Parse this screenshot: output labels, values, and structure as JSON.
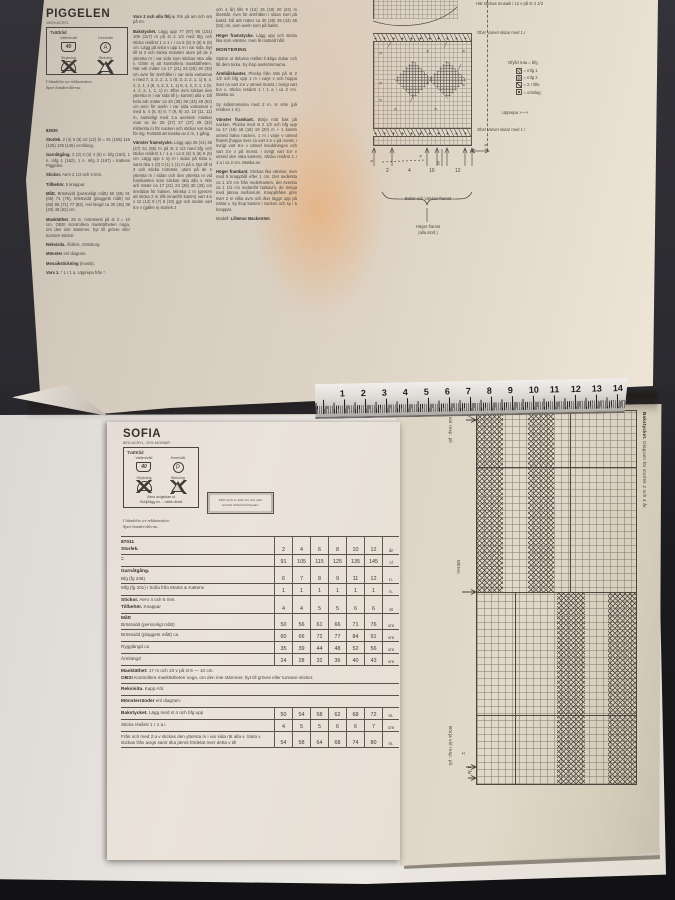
{
  "scene": {
    "background": "#2b2a2f",
    "paper_tan": "#d9cfc2",
    "paper_white": "#e7e3de",
    "glare": "#ee9646",
    "ink": "#474340"
  },
  "piggelen": {
    "title": "PIGGELEN",
    "subtitle": "100% ACRYL",
    "care": {
      "header": "Tvättråd",
      "wash": "Vattentvätt",
      "wash_temp": "40",
      "dry": "Kemtvätt",
      "dry_letter": "A",
      "iron": "Strykning",
      "bleach": "Blekning"
    },
    "reklamation": "I händelse av reklamation:",
    "reklamation2": "Spar banderollerna.",
    "columns": [
      [
        {
          "b": "83030",
          "t": ""
        },
        {
          "b": "Storlek.",
          "t": " 2 (4) 6 (8) 10 (12) år = 91 (105) 115 (125) 135 (145) centilong."
        },
        {
          "b": "Garnåtgång.",
          "t": " 2 (3) 3 (4) 4 (5) n. bfg (150), 1 n. mfg 1 (162), 1 n. mfg 2 (167) i Kattens Piggelen."
        },
        {
          "b": "Stickor.",
          "t": " Aero 2 1/2 och 3 mm."
        },
        {
          "b": "Tillbehör.",
          "t": " 5 knappar."
        },
        {
          "b": "Mått.",
          "t": " Bröstvidd (personligt mått) 50 (56) 61 (66) 71 (76), bröstvidd (plaggets mått) 54 (60) 66 (71) 77 (82). Hel längd ca 30 (35) 39 (43) 48 (52) cm."
        },
        {
          "b": "Masktäthet.",
          "t": " 28 m. mönsterst på st 3 = 10 cm. OBS! Kontrollera masktätheten noga, om den inte stämmer, byt till grövre eller tunnare stickor."
        },
        {
          "b": "Rekvisita.",
          "t": " Åhléns, Göteborg."
        },
        {
          "b": "Mönster",
          "t": " enl diagram."
        },
        {
          "b": "Mosaikstickning",
          "t": " (mosst)."
        },
        {
          "b": "Varv 1.",
          "t": " * 1 r 1 a. Upprepa från *."
        }
      ],
      [
        {
          "b": "Varv 2 och alla följ v.",
          "t": " Rm på am och am på rm."
        },
        {
          "b": "Bakstycket.",
          "t": " Lägg upp 77 (87) 95 (101) 109 (117) m på st 2 1/2 med bfg och sticka resårst 1 a 1 r i ca 5 (5) 5 (6) 6 (6) cm. Lägg på sista v upp 1 m i var sida. Byt till st 3 och sticka mönster utom på de 2 yttersta m i var sida som stickas räta alla v. Glöm ej att kontrollera masktätheten. När arb mäter ca 17 (21) 23 (26) 30 (33) cm avm för ärmhålen i var sida vartannat v med 7, 3, 2, 2, 1, 1 (8, 3, 2, 2, 1, 1) 8, 4, 2, 2, 1, 1 (8, 4, 2, 2, 1, 1) 8, 4, 2, 2, 1, 1 (8, 4, 2, 2, 1, 1, 1) m. Efter avm stickas den yttersta m i var sida till (= kantm) alla v. Då hela arb mäter ca 30 (35) 39 (43) 48 (52) cm avm för axeln i var sida vartannat v med 5, 4 (6, 6) 8, 7 (9, 9) 10, 10 (11, 11) m, samtidigt med 1:a axelavm maskar man av de 25 (27) 27 (27) 29 (33) mittersta m för nacken och stickar var sida för sig. Fortsätt att maska av 2 m, 1 gång."
        },
        {
          "b": "Vänster framstycke.",
          "t": " Lägg upp 35 (41) 45 (47) 51 (55) m på st 2 1/2 med bfg och sticka resårst 1 r 1 a i ca 5 (5) 5 (6) 6 (6) cm. Lägg upp 1 ny m i sidan på sista v, samt öka 1 (0) 0 (1) 1 (1) m på v. Byt till st 3 och sticka mönster, utom på de 2 yttersta m i sidan och den yttersta m vid framkanten som stickas räta alla v. När arb mäter ca 17 (21) 23 (26) 30 (33) cm sneddas för halsen. Minska 1 m (genom att sticka 2 m tills innanför kantm) vart 4:e v 12 (13) 9 (7) 8 (10) ggr och sedan vart 6:e v (gäller ej storlek 2"
        }
      ],
      [
        {
          "b": "",
          "t": "och 4 år) tills 9 (12) 15 (18) 20 (22) m återstår. Avm för ärmhålen i sidan som på bakst. Då arb mäter ca 30 (35) 39 (43) 48 (52) cm, avm axeln som på bakst."
        },
        {
          "b": "Höger framstycke.",
          "t": " Lägg upp och sticka lika som vänster, men åt motsatt håll."
        },
        {
          "h": "MONTERING"
        },
        {
          "b": "",
          "t": "Spänn ut delarna mellan fuktiga dukar och låt dem torka. Sy ihop axelsömmarna."
        },
        {
          "b": "Ärmhålskanter.",
          "t": " Plocka från räts på st 2 1/2 och bfg upp 1 m i varje v och hoppa över ca vart 3:e v utmed mosst, i övrigt vart 5:e v. Sticka resårst 1 r 1 a i ca 2 cm. Maska av."
        },
        {
          "b": "",
          "t": "Sy sidsömmarna med 2 m. st söm (på resåren 1 m)."
        },
        {
          "b": "Vänster framkant.",
          "t": " Börja mitt bak på nacken. Plocka med st 2 1/2 och bfg upp ca 17 (18) 18 (18) 19 (20) m + 1 kantm utmed halva nacken, 1 m i varje v utmed framst (hoppa över ca vart 4:e v på mosst, i övrigt vart 6:e v utmed sneddningen och vart 3:e v på mosst, i övrigt vart 5:e v utmed den raka kanten). Sticka resårst 1 r 1 a i ca 2 cm. Maska av."
        },
        {
          "b": "Höger framkant.",
          "t": " Stickas lika vänster, men med 5 knapphål efter 1 cm. Det nedersta ca 1 1/2 cm från nederkanten, det översta ca 1 1/2 cm nedanför halsavm, de övriga med jämna mellanrum. Knapphålen görs över 2 m vilka avm och åter läggs upp på nästa v. Sy ihop kanten i nacken och sy i 5 knappar."
        },
        {
          "b": "Lillemor Bäckström",
          "t": "",
          "pre": "Modell: "
        }
      ]
    ],
    "chart": {
      "top_note": "Här stickas mosaik i 12 v på st 2 1/2",
      "end_note": "Obs! Varvet slutar med 1 r",
      "legend_title": "Ofylld ruta = bfg",
      "legend": [
        {
          "key": "mfg1",
          "label": "= mfg 1"
        },
        {
          "key": "mfg2",
          "label": "= mfg 2"
        },
        {
          "key": "rtills",
          "label": "= 2 r tills."
        },
        {
          "key": "omslag",
          "label": "= omslag"
        }
      ],
      "repeat_note": "Upprepa ×—×",
      "size_marks": [
        "2",
        "4",
        "10",
        "6",
        "12"
      ],
      "bracket_label": "Bakst och vänster framst",
      "below_label_1": "Höger framst",
      "below_label_2": "(alla storl.)"
    }
  },
  "ruler": {
    "numbers": [
      "1",
      "2",
      "3",
      "4",
      "5",
      "6",
      "7",
      "8",
      "9",
      "10",
      "11",
      "12",
      "13",
      "14"
    ]
  },
  "sofia": {
    "title": "SOFIA",
    "subtitle": "80% ACRYL, 20% MOHAIR",
    "care": {
      "header": "Tvättråd",
      "wash": "Vattentvätt",
      "wash_temp": "40",
      "dry": "Kemtvätt",
      "dry_letter": "P",
      "iron": "Strykning",
      "bleach": "Blekning",
      "note1": "Vänd avigsidan ut",
      "note2": "Skölj/lägg ev. – häfta direkt"
    },
    "copyright_1": "Eftertryck av bild och text utan",
    "copyright_2": "särskilt tillstånd förbjudes.",
    "reklamation": "I händelse av reklamation:",
    "reklamation2": "Spar banderollerna.",
    "table": {
      "rows": [
        {
          "lines": [
            {
              "b": "87011",
              "t": ""
            },
            {
              "b": "Storlek.",
              "t": ""
            }
          ],
          "vals": [
            "2",
            "4",
            "6",
            "8",
            "10",
            "12"
          ],
          "unit": "år"
        },
        {
          "lines": [
            {
              "b": "=",
              "t": ""
            }
          ],
          "vals": [
            "91",
            "105",
            "115",
            "125",
            "135",
            "145"
          ],
          "unit": "cl"
        },
        {
          "lines": [
            {
              "b": "Garnåtgång.",
              "t": ""
            },
            {
              "b": "",
              "t": "Bfg (fg 238)"
            }
          ],
          "vals": [
            "6",
            "7",
            "8",
            "9",
            "11",
            "12"
          ],
          "unit": "n."
        },
        {
          "lines": [
            {
              "b": "",
              "t": "Mfg (fg 201) i Sofia från Marks & Kattens"
            }
          ],
          "vals": [
            "1",
            "1",
            "1",
            "1",
            "1",
            "1"
          ],
          "unit": "n."
        },
        {
          "lines": [
            {
              "b": "Stickor.",
              "t": " Aero 4 och 5 mm."
            },
            {
              "b": "Tillbehör.",
              "t": " Knappar"
            }
          ],
          "vals": [
            "4",
            "4",
            "5",
            "5",
            "6",
            "6"
          ],
          "unit": "st"
        },
        {
          "lines": [
            {
              "b": "Mått",
              "t": ""
            },
            {
              "b": "",
              "t": "Bröstvidd (personligt mått)"
            }
          ],
          "vals": [
            "50",
            "56",
            "61",
            "66",
            "71",
            "76"
          ],
          "unit": "cm"
        },
        {
          "lines": [
            {
              "b": "",
              "t": "Bröstvidd (plaggets mått) ca"
            }
          ],
          "vals": [
            "60",
            "66",
            "72",
            "77",
            "84",
            "91"
          ],
          "unit": "cm"
        },
        {
          "lines": [
            {
              "b": "",
              "t": "Rygglängd ca"
            }
          ],
          "vals": [
            "35",
            "39",
            "44",
            "48",
            "52",
            "56"
          ],
          "unit": "cm"
        },
        {
          "lines": [
            {
              "b": "",
              "t": "Ärmlängd"
            }
          ],
          "vals": [
            "24",
            "28",
            "32",
            "36",
            "40",
            "43"
          ],
          "unit": "cm"
        },
        {
          "lines": [
            {
              "b": "Masktäthet:",
              "t": " 17 m och 23 v på st 5 — 10 cm."
            },
            {
              "b": "OBS!",
              "t": " Kontrollera masktätheten noga, om den inte stämmer, byt till grövre eller tunnare stickor."
            }
          ],
          "vals": null
        },
        {
          "lines": [
            {
              "b": "Rekvisita.",
              "t": " Kapp Ahl."
            }
          ],
          "vals": null
        },
        {
          "lines": [
            {
              "b": "Mönsterränder",
              "t": " enl diagram."
            }
          ],
          "vals": null
        },
        {
          "lines": [
            {
              "b": "Bakstycket.",
              "t": " Lägg med st 4 och bfg upp"
            }
          ],
          "vals": [
            "50",
            "54",
            "58",
            "62",
            "68",
            "72"
          ],
          "unit": "m."
        },
        {
          "lines": [
            {
              "b": "",
              "t": "Sticka resårst 1 r 1 a i"
            }
          ],
          "vals": [
            "4",
            "5",
            "5",
            "6",
            "6",
            "7"
          ],
          "unit": "cm"
        },
        {
          "lines": [
            {
              "b": "",
              "t": "Från och med 2:a v stickas den yttersta m i var sida rät alla v. Sista v stickas från avigs samt öka jämnt fördelat över detta v till"
            }
          ],
          "vals": [
            "54",
            "58",
            "64",
            "68",
            "74",
            "80"
          ],
          "unit": "m."
        }
      ]
    },
    "chart": {
      "title": "Bakstycket.",
      "subtitle": "Diagram för storlek 2 och 4 år.",
      "stop": "Sluta vid resp. pil",
      "stop_marks": [
        "4",
        "2"
      ],
      "middle": "Mitten",
      "start": "Börja vid resp. pil.",
      "start_marks": [
        "2",
        "4 år"
      ]
    }
  }
}
